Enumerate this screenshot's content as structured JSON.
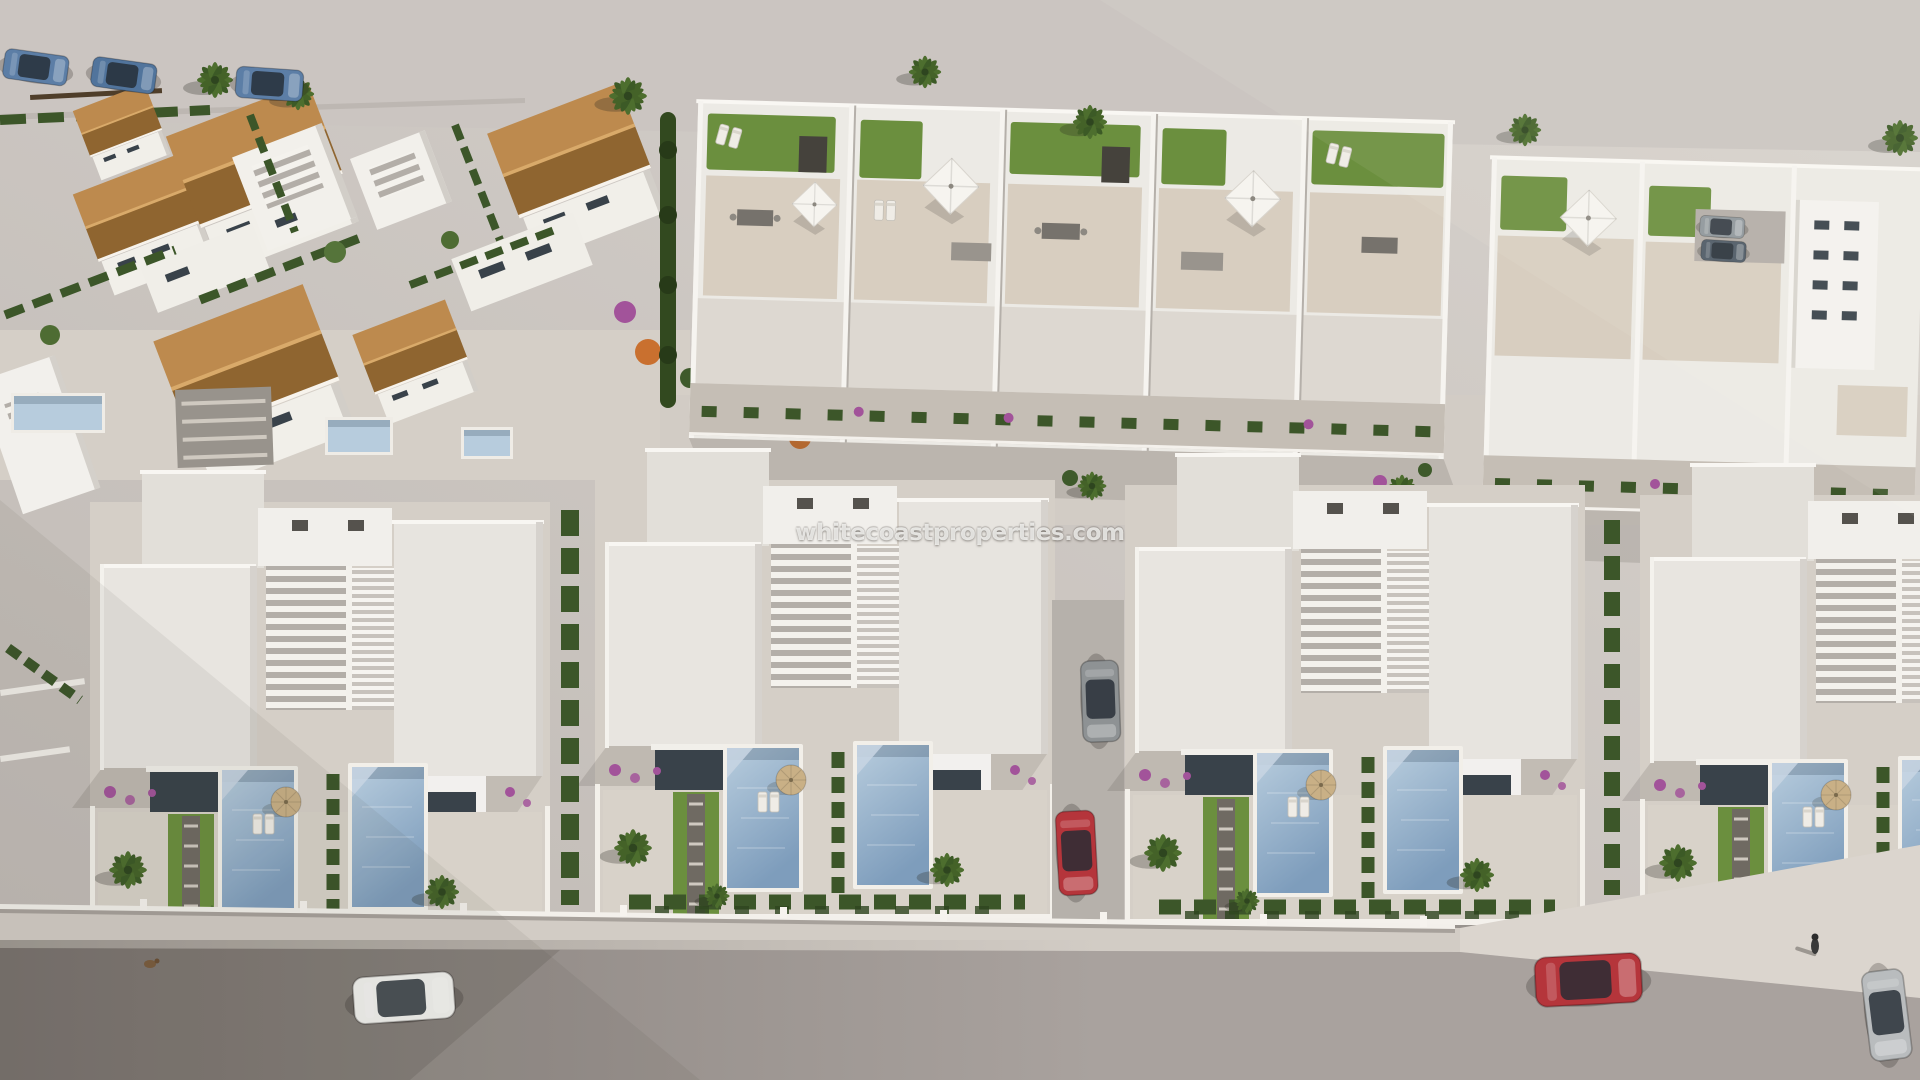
{
  "watermark": {
    "text": "whitecoastproperties.com"
  },
  "palette": {
    "ground_light": "#d8d3ce",
    "ground_dark": "#bfb9b4",
    "road_top": "#cbc5c1",
    "road_bottom": "#a9a29e",
    "sidewalk": "#d2ccc5",
    "white_sun": "#f7f5f1",
    "white_shade": "#d6d2cd",
    "roof_flat": "#e8e5e0",
    "terrace_tile": "#d8cec0",
    "balcony": "#c5beb5",
    "tile_sun": "#bd8a4e",
    "tile_shade": "#8f6530",
    "lawn": "#6b8f3e",
    "hedge": "#3c5629",
    "palm_leaf": "#4d6e2e",
    "pool_light": "#b7ccdd",
    "pool_deep": "#7e9dbc",
    "glass": "#39424a",
    "gravel": "#b6b1ab",
    "car_blue": "#5c7ea6",
    "car_red": "#b5353b",
    "car_white": "#f2f1ee",
    "car_silver": "#b9bcbe",
    "parasol_tan": "#c9b086",
    "bougainvillea": "#a2539a",
    "orange_tree": "#c9702f"
  },
  "scene": {
    "view": "aerial 3D render of a residential development",
    "top_left_area": "villas with terracotta gable roofs, hedges and plunge pools",
    "top_right_area": "townhouse row with rooftop solarium terraces, lawns and parasols",
    "bottom_area": "modern flat-roof villas with louvered pergolas, private pools and palm gardens",
    "vehicle_counts": {
      "blue_cars_top_road": 3,
      "white_car_bottom_road": 1,
      "red_car_bottom_road": 1,
      "silver_car_bottom_edge": 1,
      "red_car_driveway": 1,
      "grey_car_driveway": 1,
      "parked_cars_courtyard": 2
    }
  }
}
